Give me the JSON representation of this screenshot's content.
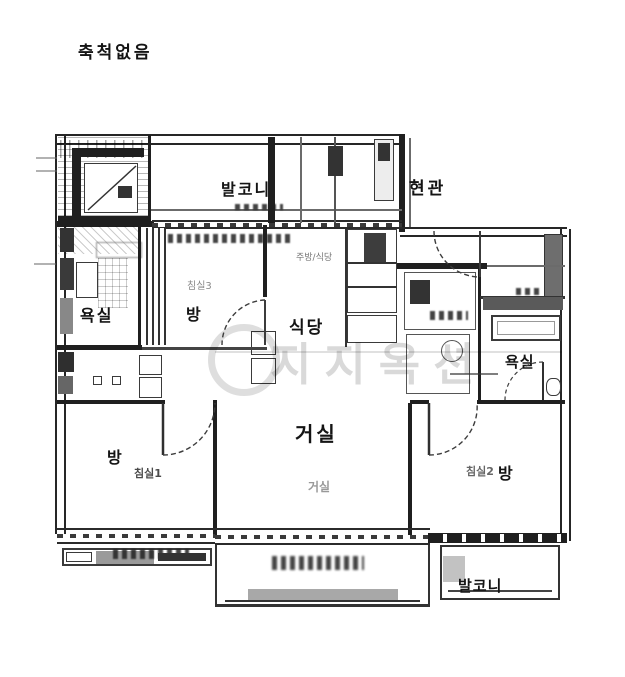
{
  "scale_note": "축척없음",
  "watermark": {
    "text": "지지옥션"
  },
  "rooms": {
    "balcony_top": {
      "label": "발코니"
    },
    "entrance": {
      "label": "현관"
    },
    "bathroom_left": {
      "label": "욕실"
    },
    "bedroom_top": {
      "label": "방",
      "sub_label": "침실3"
    },
    "dining": {
      "label": "식당",
      "sub_label": "주방/식당"
    },
    "bathroom_right": {
      "label": "욕실"
    },
    "living": {
      "label": "거실",
      "sub_label": "거실"
    },
    "bedroom_left": {
      "label": "방",
      "sub_label": "침실1"
    },
    "bedroom_right": {
      "label": "방",
      "sub_label": "침실2"
    },
    "hallway": {
      "label": "복도"
    },
    "balcony_bottom": {
      "label": "발코니"
    }
  },
  "colors": {
    "ink": "#1f1f1f",
    "paper": "#ffffff",
    "watermark": "rgba(0,0,0,0.15)"
  }
}
